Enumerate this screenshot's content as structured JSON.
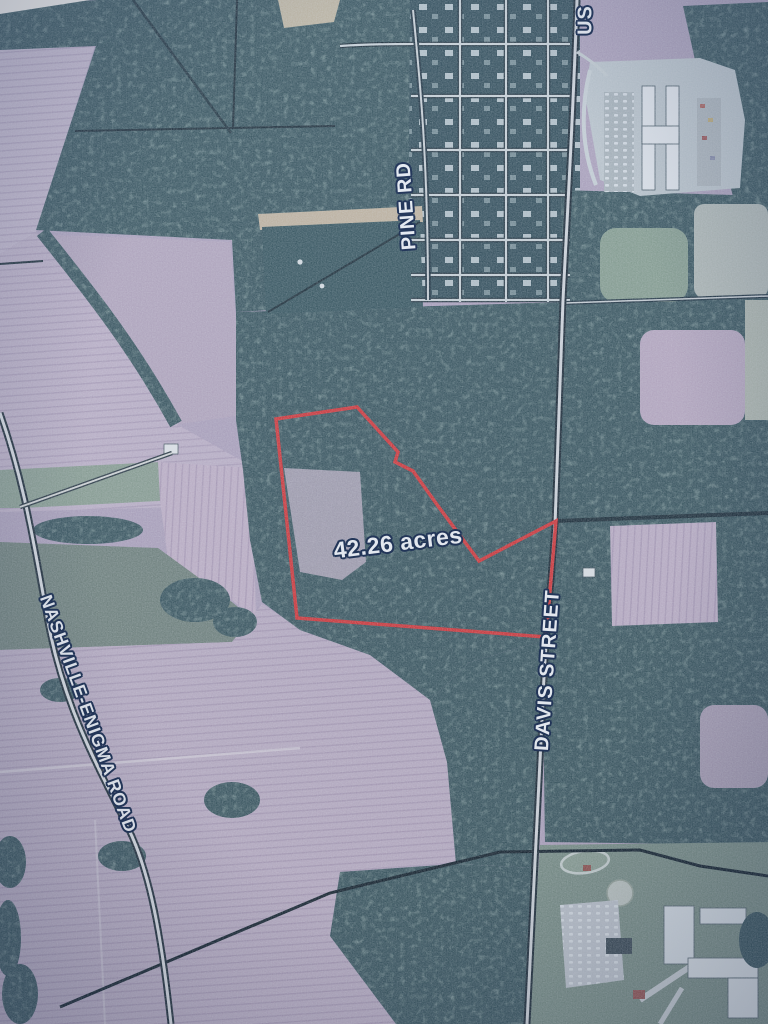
{
  "map": {
    "description_label": "aerial parcel map photo",
    "acreage_label": "42.26 acres",
    "road_labels": {
      "us_highway": "US",
      "pine_rd": "PINE RD",
      "nashville_enigma_road": "NASHVILLE-ENIGMA ROAD",
      "davis_street": "DAVIS STREET"
    },
    "property_boundary": {
      "color": "#d63a3a",
      "points": [
        [
          276,
          419
        ],
        [
          357,
          407
        ],
        [
          398,
          452
        ],
        [
          395,
          462
        ],
        [
          413,
          471
        ],
        [
          438,
          506
        ],
        [
          479,
          561
        ],
        [
          556,
          521
        ],
        [
          546,
          637
        ],
        [
          297,
          618
        ]
      ]
    },
    "label_style": {
      "text_color": "#f2f6f9",
      "outline_color": "#1d3152"
    }
  }
}
